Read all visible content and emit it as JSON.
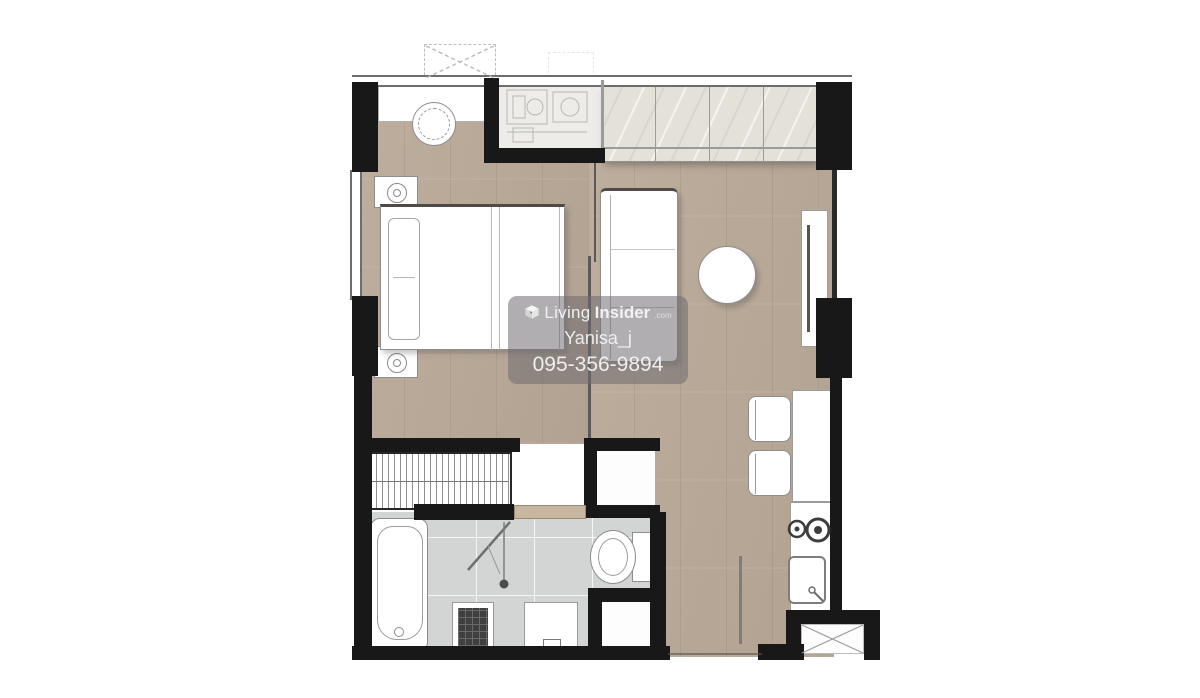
{
  "watermark": {
    "logo_icon": "living-insider-cube-icon",
    "brand_first": "Living",
    "brand_second": "Insider",
    "brand_suffix": ".com",
    "username": "Yanisa_j",
    "phone": "095-356-9894"
  },
  "colors": {
    "wall": "#181818",
    "wood": "#b8a897",
    "tile": "#d3d5d5",
    "marble": "#e4e1d9",
    "utility": "#edece8",
    "fixture_outline": "#8d8d8d",
    "door_wood": "#c8b7a0",
    "watermark_bg": "rgba(112,108,112,0.55)",
    "watermark_text": "#f5f4f6"
  },
  "floorplan": {
    "rooms": [
      "bedroom",
      "living-area",
      "kitchenette",
      "bathroom",
      "entrance-hall"
    ],
    "fixtures": [
      "bed",
      "nightstand",
      "washing-machine",
      "window-bench",
      "built-in-wardrobe",
      "hanging-wardrobe",
      "sliding-partition",
      "sofa",
      "round-table",
      "tv-console",
      "fridge-niche",
      "dining-counter",
      "chair",
      "two-burner-hob",
      "kitchen-sink",
      "bathtub",
      "shower",
      "floor-drain",
      "vanity-basin",
      "toilet",
      "storage-closet",
      "service-shaft",
      "ac-condenser-unit"
    ]
  }
}
